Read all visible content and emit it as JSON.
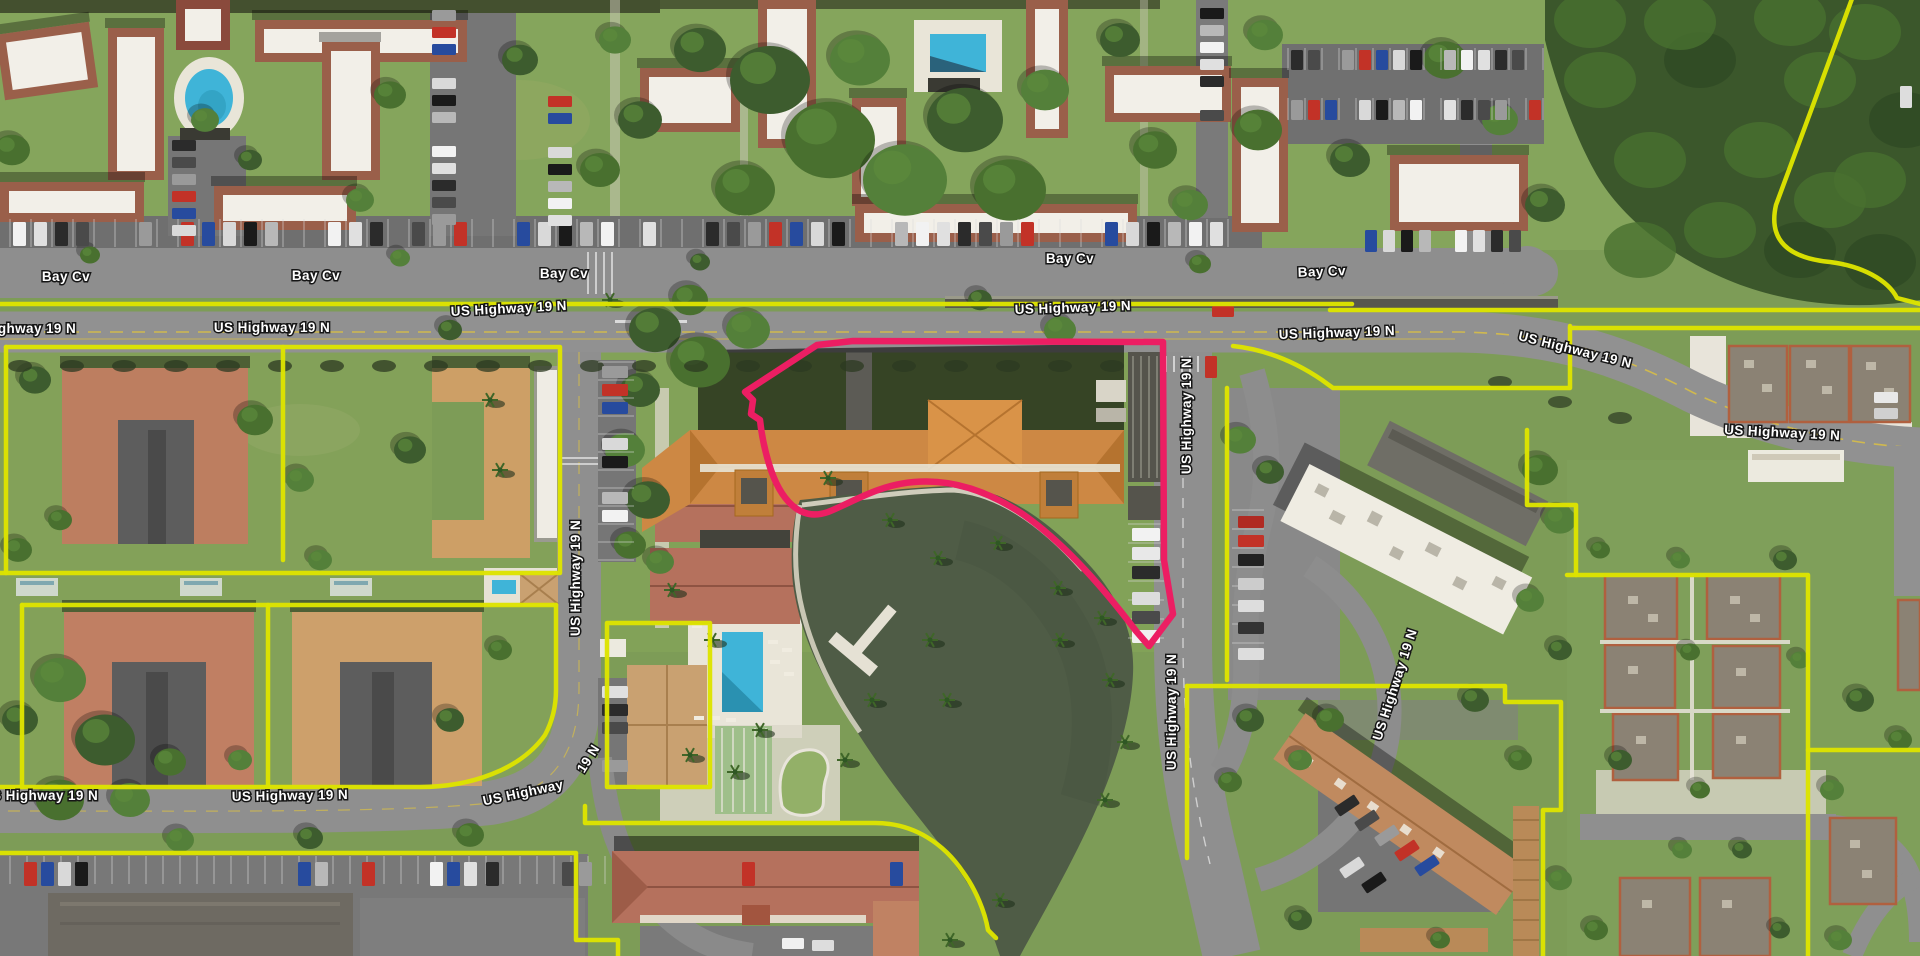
{
  "map": {
    "type": "satellite-parcel-view",
    "colors": {
      "parcel_line": "#dde300",
      "selected_parcel": "#ec1e63",
      "label_fill": "#ffffff",
      "label_halo": "#161616",
      "water": "#4f5c46",
      "pool": "#3fb4d8",
      "grass": "#7d9c57",
      "road": "#8f8f8f"
    },
    "road_labels": [
      {
        "id": "bay-cv-1",
        "text": "Bay Cv",
        "x": 66,
        "y": 281,
        "r": 0
      },
      {
        "id": "bay-cv-2",
        "text": "Bay Cv",
        "x": 316,
        "y": 280,
        "r": 0
      },
      {
        "id": "bay-cv-3",
        "text": "Bay Cv",
        "x": 564,
        "y": 278,
        "r": 0
      },
      {
        "id": "bay-cv-4",
        "text": "Bay Cv",
        "x": 1070,
        "y": 263,
        "r": 0
      },
      {
        "id": "bay-cv-5",
        "text": "Bay Cv",
        "x": 1322,
        "y": 276,
        "r": -2
      },
      {
        "id": "us19-1",
        "text": "US Highway 19 N",
        "x": 18,
        "y": 333,
        "r": 0
      },
      {
        "id": "us19-2",
        "text": "US Highway 19 N",
        "x": 272,
        "y": 332,
        "r": 0
      },
      {
        "id": "us19-3",
        "text": "US Highway 19 N",
        "x": 509,
        "y": 313,
        "r": -3
      },
      {
        "id": "us19-4",
        "text": "US Highway 19 N",
        "x": 1073,
        "y": 312,
        "r": -2
      },
      {
        "id": "us19-5",
        "text": "US Highway 19 N",
        "x": 1337,
        "y": 337,
        "r": -2
      },
      {
        "id": "us19-6",
        "text": "US Highway 19 N",
        "x": 1574,
        "y": 354,
        "r": 14
      },
      {
        "id": "us19-7",
        "text": "US Highway 19 N",
        "x": 1782,
        "y": 437,
        "r": 3
      },
      {
        "id": "us19-8",
        "text": "US Highway 19 N",
        "x": 40,
        "y": 800,
        "r": 0
      },
      {
        "id": "us19-9",
        "text": "US Highway 19 N",
        "x": 290,
        "y": 800,
        "r": -1
      },
      {
        "id": "us19-10a",
        "text": "US Highway",
        "x": 524,
        "y": 797,
        "r": -12
      },
      {
        "id": "us19-10b",
        "text": "19 N",
        "x": 592,
        "y": 761,
        "r": -58
      },
      {
        "id": "us19-v1",
        "text": "US Highway 19 N",
        "x": 580,
        "y": 578,
        "r": -90
      },
      {
        "id": "us19-v2",
        "text": "US Highway 19 N",
        "x": 1191,
        "y": 416,
        "r": -90
      },
      {
        "id": "us19-v3",
        "text": "US Highway 19 N",
        "x": 1176,
        "y": 712,
        "r": -90
      },
      {
        "id": "us19-v4",
        "text": "US Highway 19 N",
        "x": 1399,
        "y": 686,
        "r": -72
      }
    ]
  }
}
